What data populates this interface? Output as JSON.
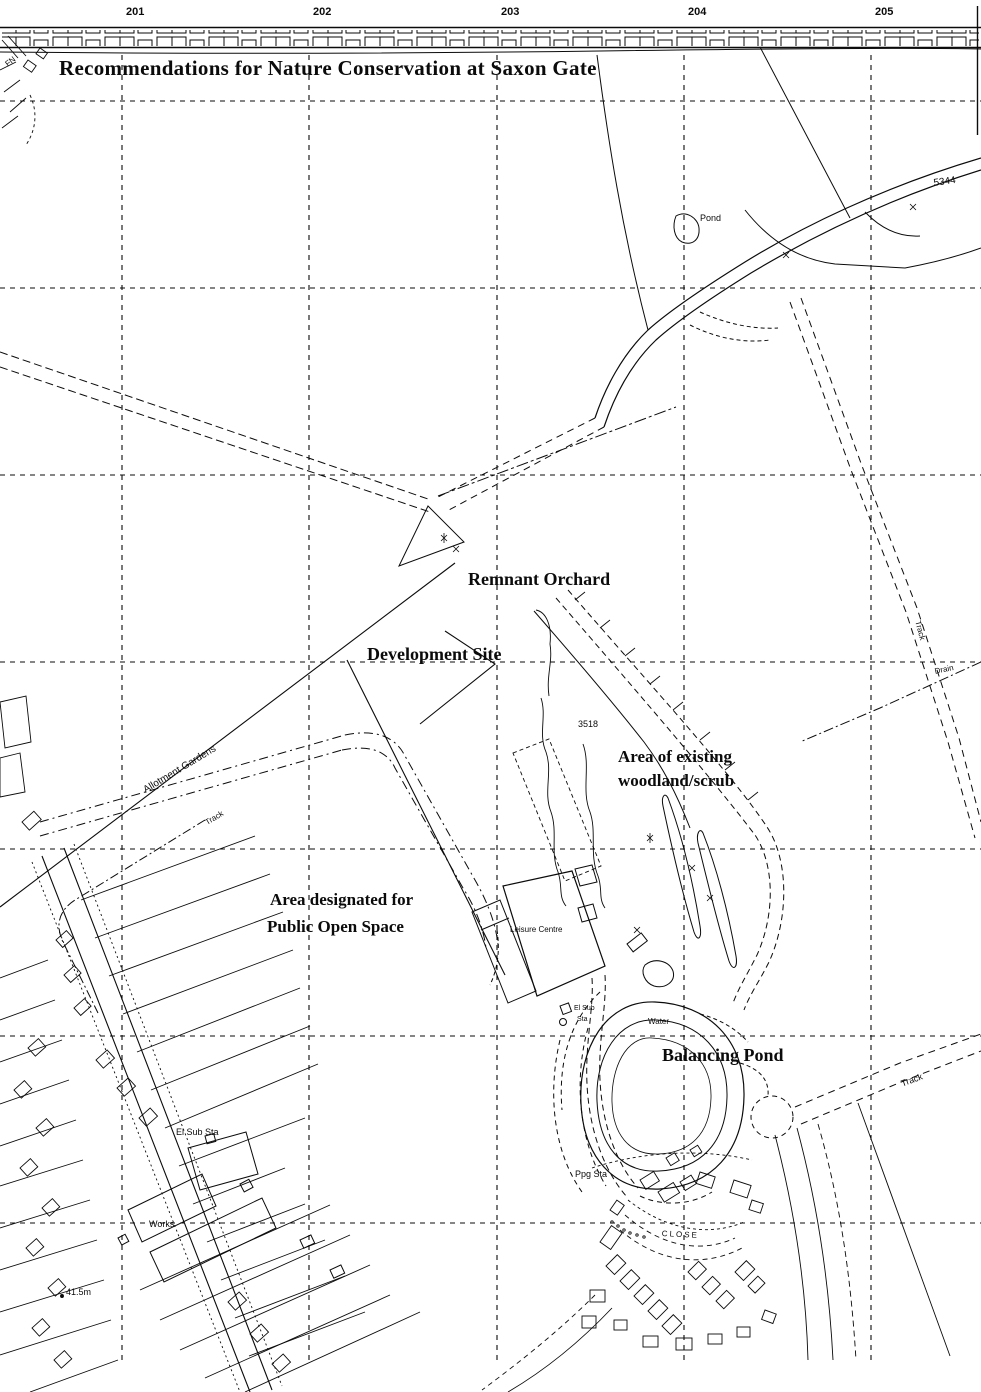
{
  "title": "Recommendations for Nature Conservation at Saxon Gate",
  "sheet": {
    "grid_numbers": [
      "201",
      "202",
      "203",
      "204",
      "205"
    ]
  },
  "annotations": {
    "remnant_orchard": "Remnant Orchard",
    "development_site": "Development Site",
    "woodland_line1": "Area of existing",
    "woodland_line2": "woodland/scrub",
    "open_space_line1": "Area designated for",
    "open_space_line2": "Public Open Space",
    "balancing_pond": "Balancing Pond"
  },
  "map_labels": {
    "pond": "Pond",
    "parcel_5344": "5344",
    "parcel_3518": "3518",
    "allotment_gardens": "Allotment Gardens",
    "track_allotments": "Track",
    "track_east": "Track",
    "track_southeast": "Track",
    "drain": "Drain",
    "leisure_centre": "Leisure Centre",
    "el_sub_line1": "El Sub",
    "el_sub_line2": "Sta",
    "el_sub_sta": "El Sub Sta",
    "water": "Water",
    "works": "Works",
    "ppg_sta": "Ppg Sta",
    "spot_height": "41.5m",
    "close_street": "CLOSE",
    "fn": "FN"
  }
}
